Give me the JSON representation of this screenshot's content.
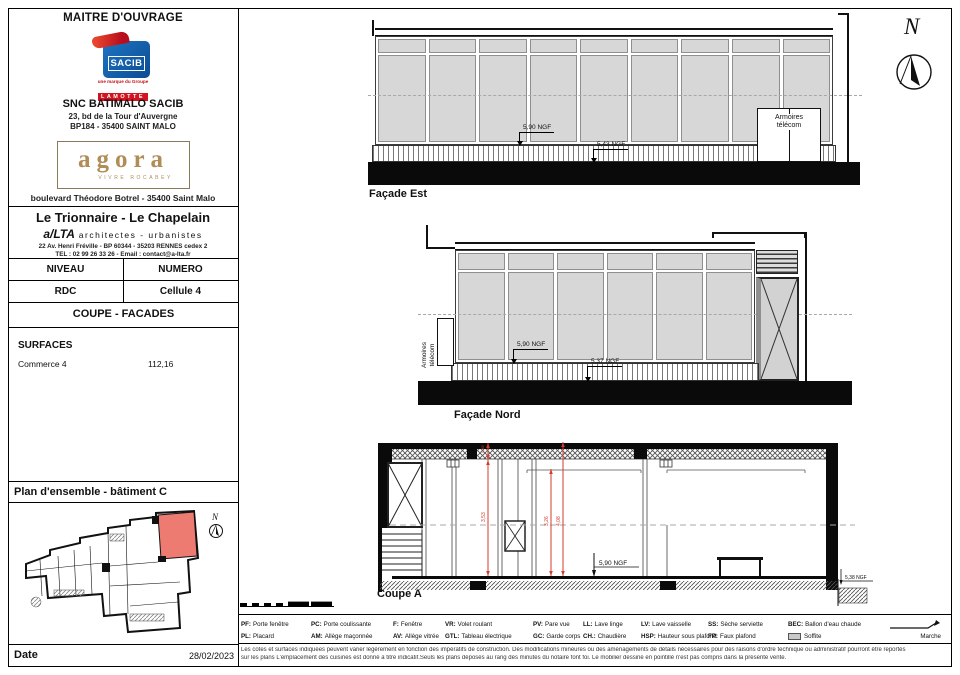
{
  "title_block": {
    "header": "MAITRE D'OUVRAGE",
    "sacib_logo": "SACIB",
    "lamotte_tagline": "une marque du Groupe",
    "lamotte": "LAMOTTE",
    "company": "SNC BATIMALO SACIB",
    "company_address1": "23, bd de la Tour d'Auvergne",
    "company_address2": "BP184 - 35400 SAINT MALO",
    "agora_logo": "agora",
    "agora_tagline": "VIVRE ROCABEY",
    "agora_address": "boulevard Théodore Botrel - 35400 Saint Malo",
    "project_name": "Le Trionnaire - Le Chapelain",
    "architect_name": "a/LTA",
    "architect_title": "architectes - urbanistes",
    "architect_address": "22 Av. Henri Fréville - BP 60344 - 35203 RENNES cedex 2",
    "architect_contact": "TEL : 02 99 26 33 26 - Email : contact@a-lta.fr",
    "niveau_label": "NIVEAU",
    "numero_label": "NUMERO",
    "niveau_value": "RDC",
    "numero_value": "Cellule 4",
    "sheet_type": "COUPE - FACADES",
    "surfaces_label": "SURFACES",
    "surface_name": "Commerce 4",
    "surface_area": "112,16",
    "plan_title": "Plan d'ensemble - bâtiment C",
    "date_label": "Date",
    "date_value": "28/02/2023"
  },
  "drawings": {
    "north_letter": "N",
    "plan_north_letter": "N",
    "facade_est": {
      "title": "Façade Est",
      "level_floor": "5,90 NGF",
      "level_ground": "5,43 NGF",
      "cabinet_label": "Armoires télécom"
    },
    "facade_nord": {
      "title": "Façade Nord",
      "level_floor": "5,90 NGF",
      "level_ground": "5,37 NGF",
      "cabinet_label": "Armoires télécom"
    },
    "coupe_a": {
      "title": "Coupe A",
      "level_floor": "5,90 NGF",
      "level_ground_right": "5,38 NGF",
      "dim_soffit": "0,45",
      "dim_ceiling": "3,53",
      "dim_beam": "3,26",
      "dim_total": "4,08"
    }
  },
  "legend": {
    "row1": [
      {
        "abbr": "PF:",
        "label": "Porte fenêtre"
      },
      {
        "abbr": "PC:",
        "label": "Porte coulissante"
      },
      {
        "abbr": "F:",
        "label": "Fenêtre"
      },
      {
        "abbr": "VR:",
        "label": "Volet roulant"
      },
      {
        "abbr": "PV:",
        "label": "Pare vue"
      },
      {
        "abbr": "LL:",
        "label": "Lave linge"
      },
      {
        "abbr": "LV:",
        "label": "Lave vaisselle"
      },
      {
        "abbr": "SS:",
        "label": "Sèche serviette"
      },
      {
        "abbr": "BEC:",
        "label": "Ballon d'eau chaude"
      }
    ],
    "row2": [
      {
        "abbr": "PL:",
        "label": "Placard"
      },
      {
        "abbr": "AM:",
        "label": "Allège maçonnée"
      },
      {
        "abbr": "AV:",
        "label": "Allège vitrée"
      },
      {
        "abbr": "GTL:",
        "label": "Tableau électrique"
      },
      {
        "abbr": "GC:",
        "label": "Garde corps"
      },
      {
        "abbr": "CH.:",
        "label": "Chaudière"
      },
      {
        "abbr": "HSP:",
        "label": "Hauteur sous plafond"
      },
      {
        "abbr": "FP:",
        "label": "Faux plafond"
      },
      {
        "abbr": "",
        "label": "Soffite"
      },
      {
        "abbr": "",
        "label": "Marche"
      }
    ]
  },
  "footnote": {
    "line1": "Les cotes et surfaces indiquées peuvent varier légèrement en fonction des impératifs de construction. Des modifications mineures ou des aménagements de détails nécessaires pour des raisons d'ordre technique ou administratif pourront être reportés",
    "line2": "sur les plans L'emplacement des cuisines est donné à titre indicatif.Seuls les plans déposés au rang des minutes du notaire font foi. Le mobilier dessiné en pointillé n'est pas compris dans la présente vente."
  },
  "colors": {
    "accent_red": "#d23b2f",
    "sacib_blue": "#1a5fae",
    "lamotte_red": "#d21420",
    "agora_gold": "#b08d57",
    "plan_highlight": "#ee7b72",
    "glazing_gray": "#d7d7d7"
  }
}
